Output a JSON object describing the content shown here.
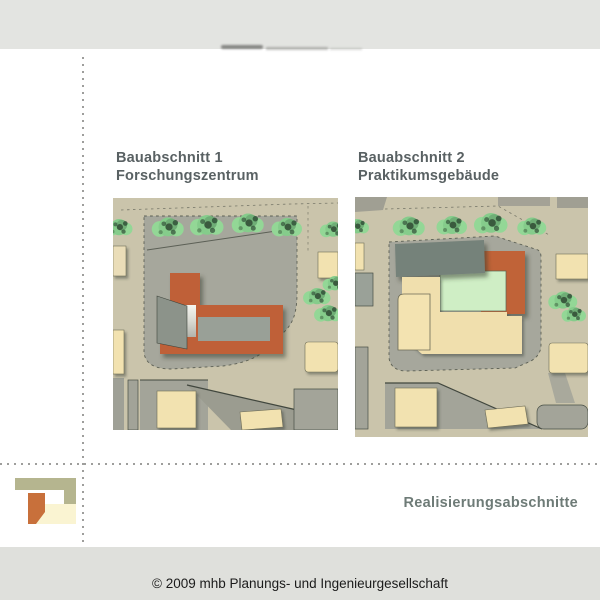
{
  "panels": [
    {
      "id": "bauabschnitt-1",
      "title_line1": "Bauabschnitt 1",
      "title_line2": "Forschungszentrum"
    },
    {
      "id": "bauabschnitt-2",
      "title_line1": "Bauabschnitt 2",
      "title_line2": "Praktikumsgebäude"
    }
  ],
  "footer": {
    "section_label": "Realisierungsabschnitte",
    "copyright": "© 2009 mhb Planungs- und Ingenieurgesellschaft"
  },
  "colors": {
    "scan_band_top": "#e3e4e1",
    "scan_band_bottom": "#dfe0dc",
    "heading_text": "#596163",
    "footer_label_text": "#6e7b77",
    "site_ground_beige": "#cac4ab",
    "parcel_gray": "#a6a79c",
    "building_orange": "#bf6137",
    "building_cream": "#f2e2b0",
    "building_mint": "#cfeec5",
    "roof_slab_gray": "#75827a",
    "tree_green": "#8fd294",
    "logo_olive": "#b5b58f",
    "logo_orange": "#c8703b",
    "logo_pale_yellow": "#faf4d2"
  }
}
